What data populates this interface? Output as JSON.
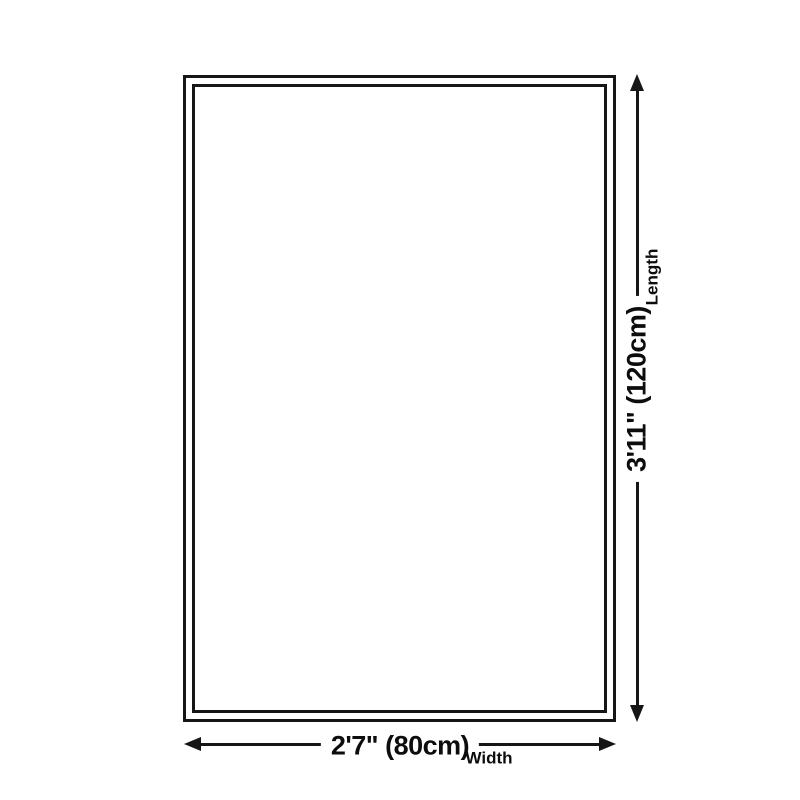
{
  "diagram": {
    "title": "product-size-diagram",
    "colors": {
      "line": "#161616",
      "background": "#ffffff",
      "text": "#0d0d0d"
    },
    "dimensions": {
      "width": {
        "value": "2'7\" (80cm)",
        "name": "Width"
      },
      "length": {
        "value": "3'11\" (120cm)",
        "name": "Length"
      }
    }
  }
}
